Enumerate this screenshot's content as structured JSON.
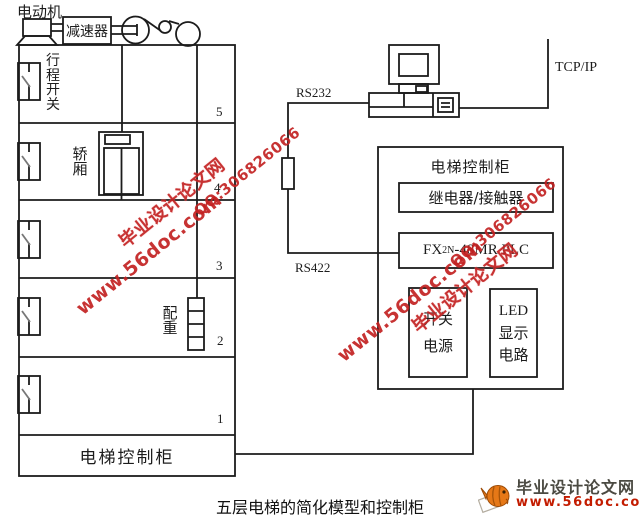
{
  "diagram": {
    "caption": "五层电梯的简化模型和控制柜",
    "model": {
      "motor": "电动机",
      "reducer": "减速器",
      "travel_switch": "行程开关",
      "car": "轿厢",
      "counterweight": "配重",
      "cabinet": "电梯控制柜",
      "floors": [
        "5",
        "4",
        "3",
        "2",
        "1"
      ]
    },
    "links": {
      "rs232": "RS232",
      "rs422": "RS422",
      "tcpip": "TCP/IP"
    },
    "cabinet": {
      "title": "电梯控制柜",
      "relay": "继电器/接触器",
      "plc": {
        "prefix": "FX",
        "sub": "2N",
        "suffix": "-48MR PLC"
      },
      "power": [
        "开关",
        "电源"
      ],
      "led": [
        "LED",
        "显示",
        "电路"
      ]
    }
  },
  "watermark": {
    "site": "毕业设计论文网",
    "url": "www.56doc.com",
    "qq": "QQ:306826066",
    "color": "#c32222"
  },
  "logo": {
    "site": "毕业设计论文网",
    "url": "www.56doc.com",
    "text_color": "#4b4a42",
    "url_color": "#c31c00"
  },
  "colors": {
    "line": "#1c1c1c",
    "background": "#ffffff"
  }
}
